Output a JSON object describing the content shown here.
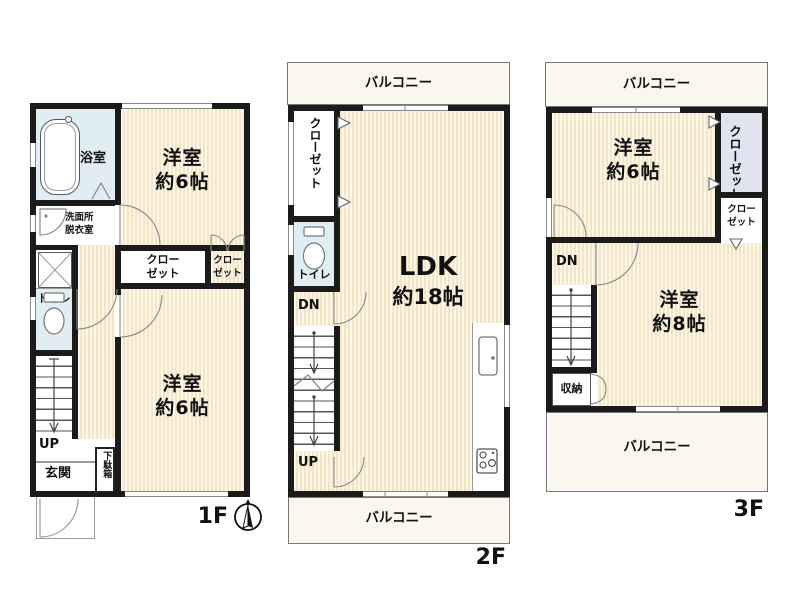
{
  "colors": {
    "wall": "#1b1b1b",
    "room_floor_light": "#fdf7ea",
    "room_floor_stripe": "#f4e5c6",
    "wet_room": "#e0edf2",
    "closet_accent": "#e2e3f0",
    "balcony": "#faf7ee",
    "outline_gray": "#888888"
  },
  "icons": {
    "compass": "north-arrow",
    "bathtub": "bathtub",
    "toilet": "toilet-bowl",
    "washbasin": "washbasin-quarter-circle",
    "washer_pan": "washing-machine-pan-x",
    "kitchen_sink": "kitchen-sink",
    "stove": "three-burner-stove"
  },
  "floor1": {
    "floor_label": "1F",
    "bath": "浴室",
    "washroom": [
      "洗面所",
      "脱衣室"
    ],
    "toilet": "トイレ",
    "room_north": [
      "洋室",
      "約6帖"
    ],
    "closet_center": [
      "クロー",
      "ゼット"
    ],
    "closet_east": [
      "クロー",
      "ゼット"
    ],
    "room_south": [
      "洋室",
      "約6帖"
    ],
    "stairs_up": "UP",
    "entrance": "玄関",
    "shoe_box": "下駄箱"
  },
  "floor2": {
    "floor_label": "2F",
    "balcony_north": "バルコニー",
    "balcony_south": "バルコニー",
    "closet_vertical": "クローゼット",
    "toilet": "トイレ",
    "stairs_down": "DN",
    "stairs_up": "UP",
    "ldk": [
      "LDK",
      "約18帖"
    ]
  },
  "floor3": {
    "floor_label": "3F",
    "balcony_north": "バルコニー",
    "balcony_south": "バルコニー",
    "room_north": [
      "洋室",
      "約6帖"
    ],
    "closet_vertical": "クローゼット",
    "closet_small": [
      "クロー",
      "ゼット"
    ],
    "stairs_down": "DN",
    "storage": "収納",
    "room_main": [
      "洋室",
      "約8帖"
    ]
  }
}
